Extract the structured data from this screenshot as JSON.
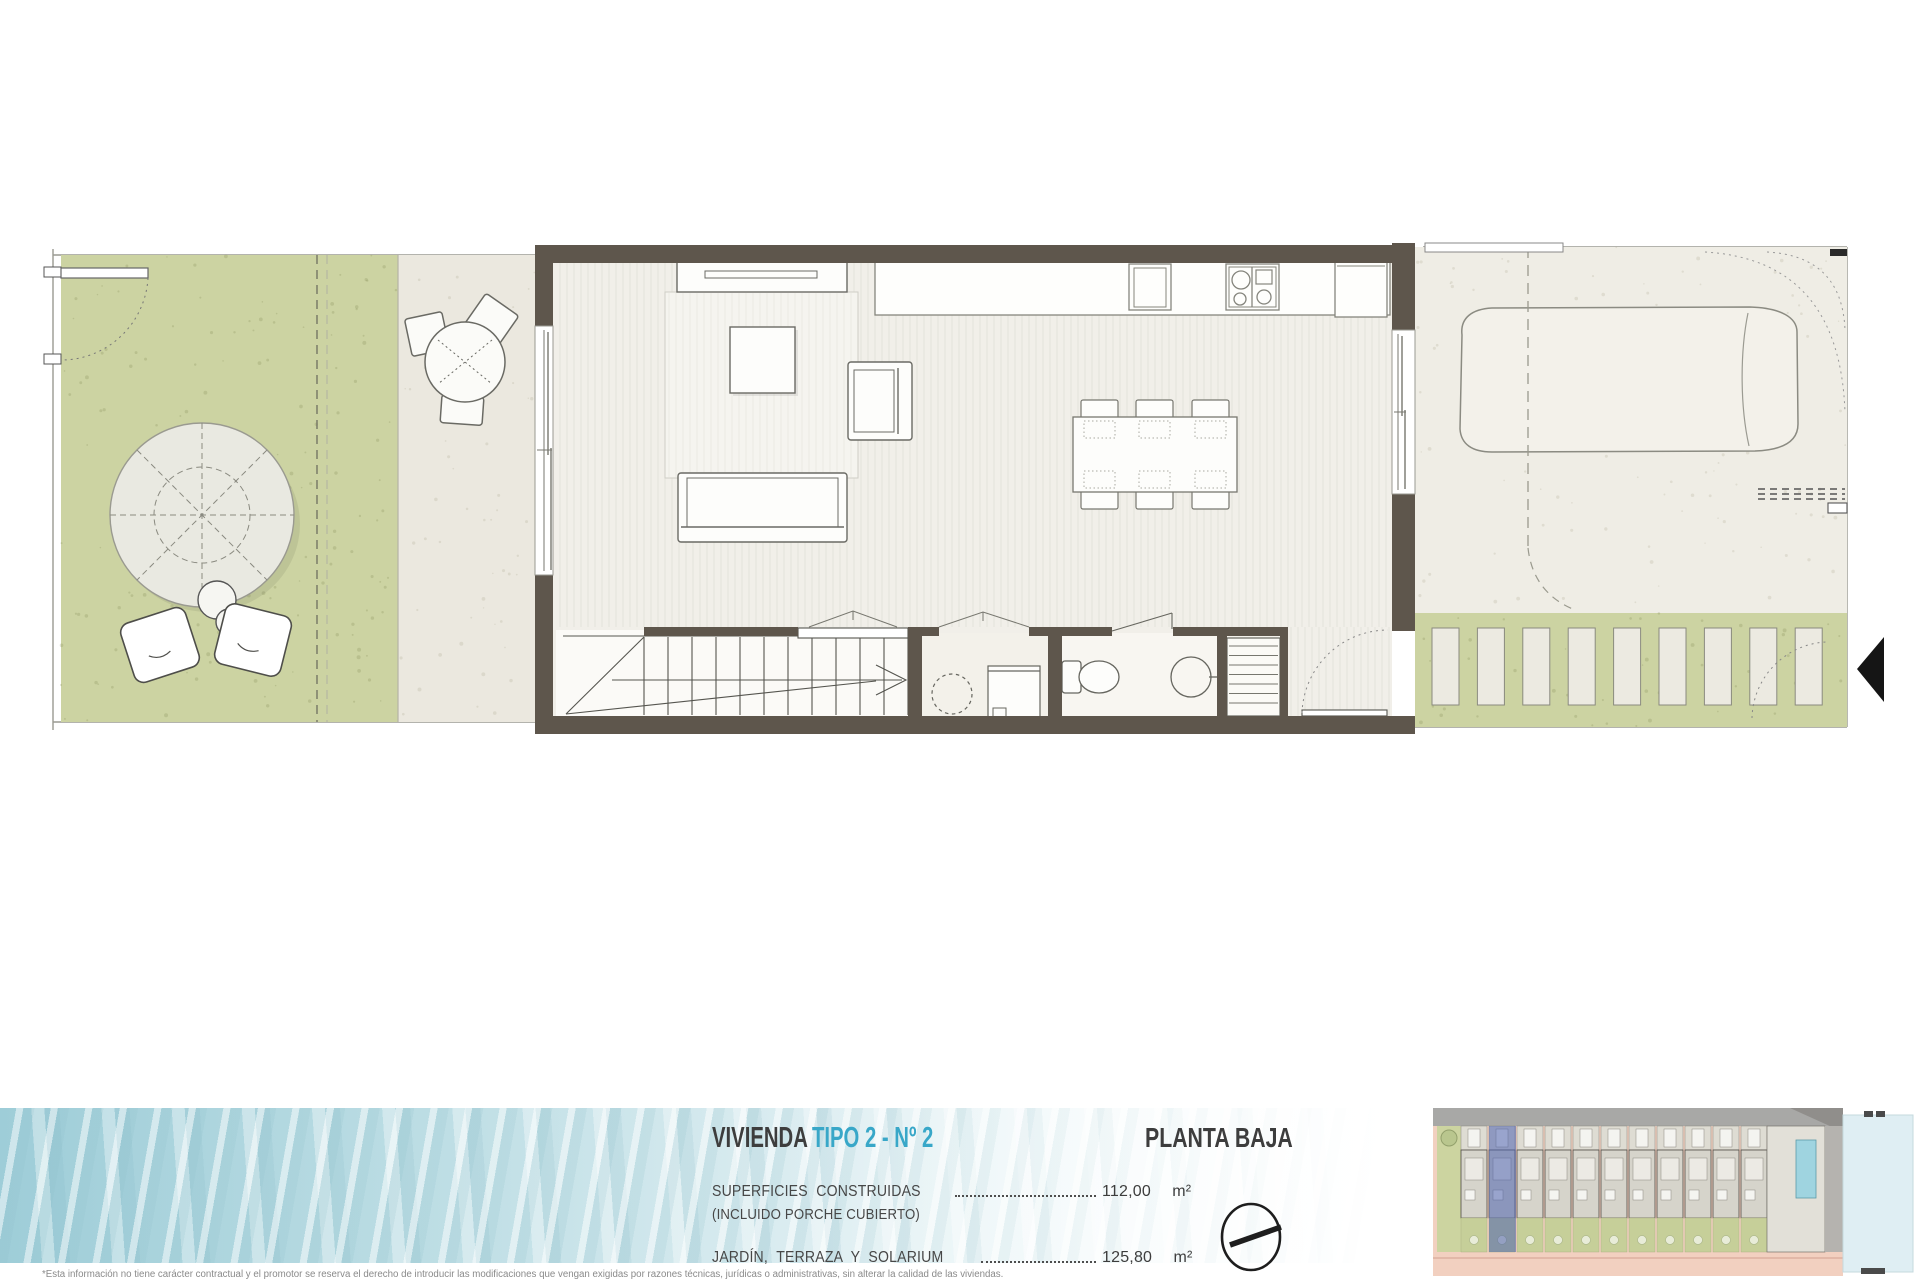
{
  "title": {
    "dwelling_label": "VIVIENDA",
    "dwelling_type": "TIPO 2 - Nº 2",
    "floor_label": "PLANTA BAJA"
  },
  "areas": {
    "rows": [
      {
        "label": "SUPERFICIES  CONSTRUIDAS",
        "sublabel": "(INCLUIDO PORCHE CUBIERTO)",
        "value": "112,00",
        "unit": "m²"
      },
      {
        "label": "JARDÍN,  TERRAZA  Y  SOLARIUM",
        "value": "125,80",
        "unit": "m²"
      }
    ]
  },
  "disclaimer": "*Esta información no tiene carácter contractual y el promotor se reserva el derecho de introducir las modificaciones que vengan exigidas por razones técnicas, jurídicas o administrativas, sin alterar la calidad de las viviendas.",
  "icons": {
    "north": "north-arrow",
    "entrance": "entrance-arrow"
  },
  "colors": {
    "accent_cyan": "#38a7c8",
    "heading_dark": "#3d3d3d",
    "wall_taupe": "#5e564c",
    "grass_green": "#ccd3a2",
    "paving": "#edebe2",
    "interior_floor": "#f1efe9",
    "water_blue": "#9ecdd8",
    "keymap_highlight": "#4f63b0",
    "keymap_road_pink": "#f2d0c0",
    "keymap_pool_blue": "#9fd4e0"
  }
}
